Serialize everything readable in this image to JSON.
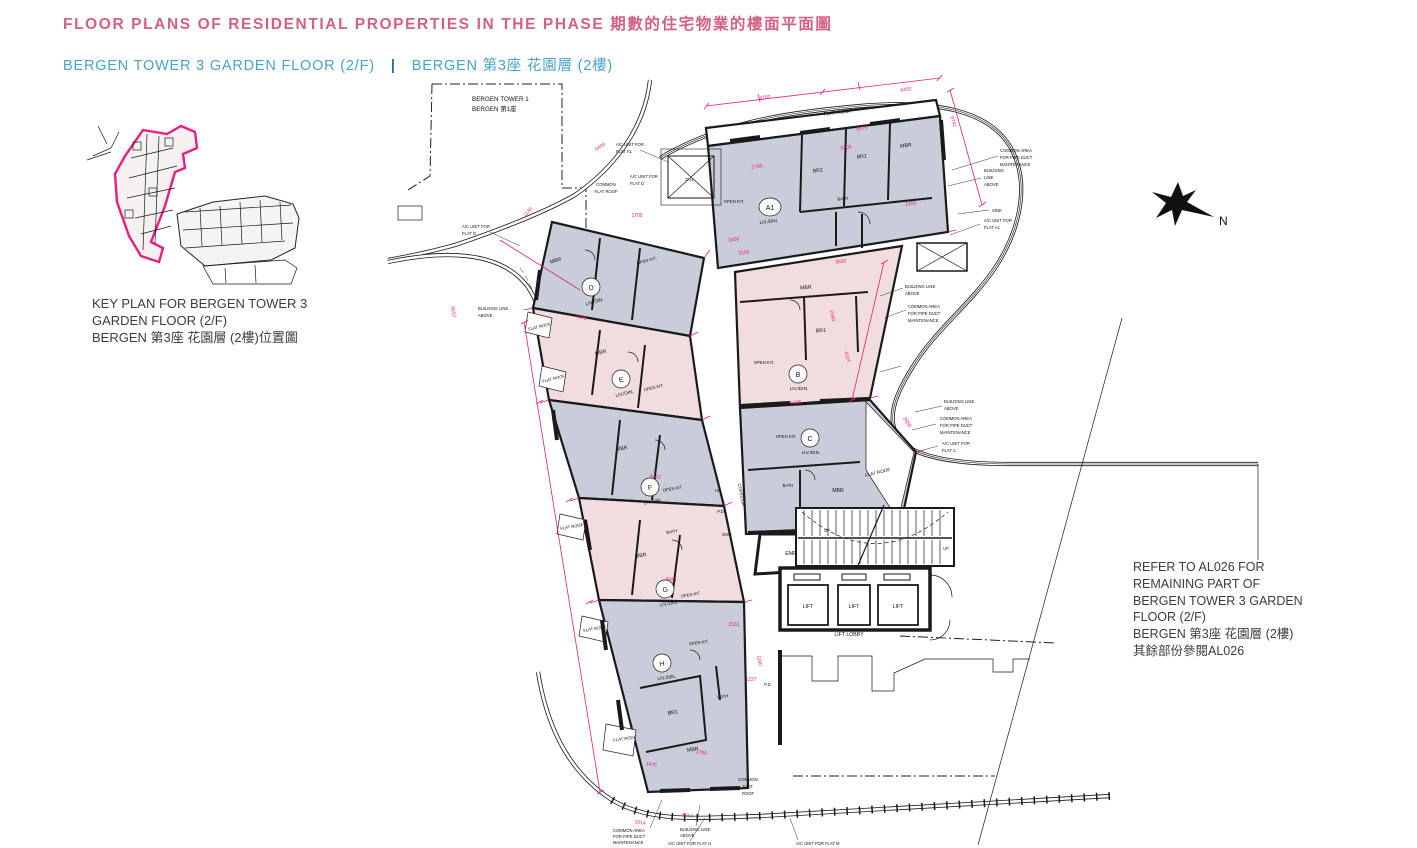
{
  "header": {
    "title": "FLOOR PLANS OF RESIDENTIAL PROPERTIES IN THE PHASE 期數的住宅物業的樓面平面圖",
    "subtitle_en": "BERGEN TOWER 3 GARDEN FLOOR (2/F)",
    "divider": "|",
    "subtitle_zh": "BERGEN 第3座 花園層 (2樓)"
  },
  "key_plan": {
    "caption_1": "KEY PLAN FOR BERGEN TOWER 3",
    "caption_2": "GARDEN FLOOR (2/F)",
    "caption_3": "BERGEN 第3座 花園層 (2樓)位置圖"
  },
  "refer_note": {
    "line_1": "REFER TO AL026 FOR",
    "line_2": "REMAINING PART OF",
    "line_3": "BERGEN TOWER 3 GARDEN",
    "line_4": "FLOOR (2/F)",
    "line_5": "BERGEN 第3座 花園層 (2樓)",
    "line_6": "其餘部份參閱AL026"
  },
  "site": {
    "tower1_line1": "BERGEN TOWER 1",
    "tower1_line2": "BERGEN 第1座",
    "north": "N"
  },
  "plan": {
    "units": {
      "a1": "A1",
      "b": "B",
      "c": "C",
      "d": "D",
      "e": "E",
      "f": "F",
      "g": "G",
      "h": "H"
    },
    "rooms": {
      "liv_din": "LIV./DIN.",
      "mbr": "MBR",
      "br1": "BR1",
      "br2": "BR2",
      "bath": "BATH",
      "open_kit": "OPEN KIT.",
      "flat_roof": "FLAT ROOF"
    },
    "common": [
      "COMMON",
      "FLAT",
      "ROOF"
    ],
    "core": {
      "emr": "EMR",
      "lift": "LIFT",
      "lift_lobby": "LIFT LOBBY",
      "up": "UP",
      "hr": "HR",
      "pd": "P.D.",
      "emc": "EMC",
      "corridor": "CORRIDOR",
      "dh": "D.H."
    },
    "callouts": {
      "building_line2": [
        "BUILDING LINE",
        "ABOVE"
      ],
      "building_line3": [
        "BUILDING",
        "LINE",
        "ABOVE"
      ],
      "common_area3": [
        "COMMON AREA",
        "FOR PIPE DUCT",
        "MAINTENANCE"
      ],
      "sink": "SINK",
      "ac_a1": [
        "A/C UNIT FOR",
        "FLAT A1"
      ],
      "ac_c": [
        "A/C UNIT FOR",
        "FLAT C"
      ],
      "ac_d": [
        "A/C UNIT FOR",
        "FLAT D"
      ],
      "ac_h": "A/C UNIT FOR FLAT H",
      "ac_m": "A/C UNIT FOR FLAT M"
    },
    "dims": [
      "4750",
      "6450",
      "9741",
      "6575",
      "3700",
      "2700",
      "1450",
      "1650",
      "3100",
      "3650",
      "5425",
      "4114",
      "2850",
      "4075",
      "4012",
      "1700",
      "5400",
      "1130",
      "4492",
      "4481",
      "1531",
      "1227",
      "1780",
      "1475",
      "5014",
      "2090",
      "2014",
      "1190"
    ]
  },
  "colors": {
    "title_pink": "#d4607f",
    "subtitle_blue": "#4aa2c4",
    "divider_blue": "#2a6f96",
    "dim_magenta": "#e91d80",
    "unit_fill_pink": "#f1dddd",
    "unit_fill_gray": "#c8cdd9"
  }
}
